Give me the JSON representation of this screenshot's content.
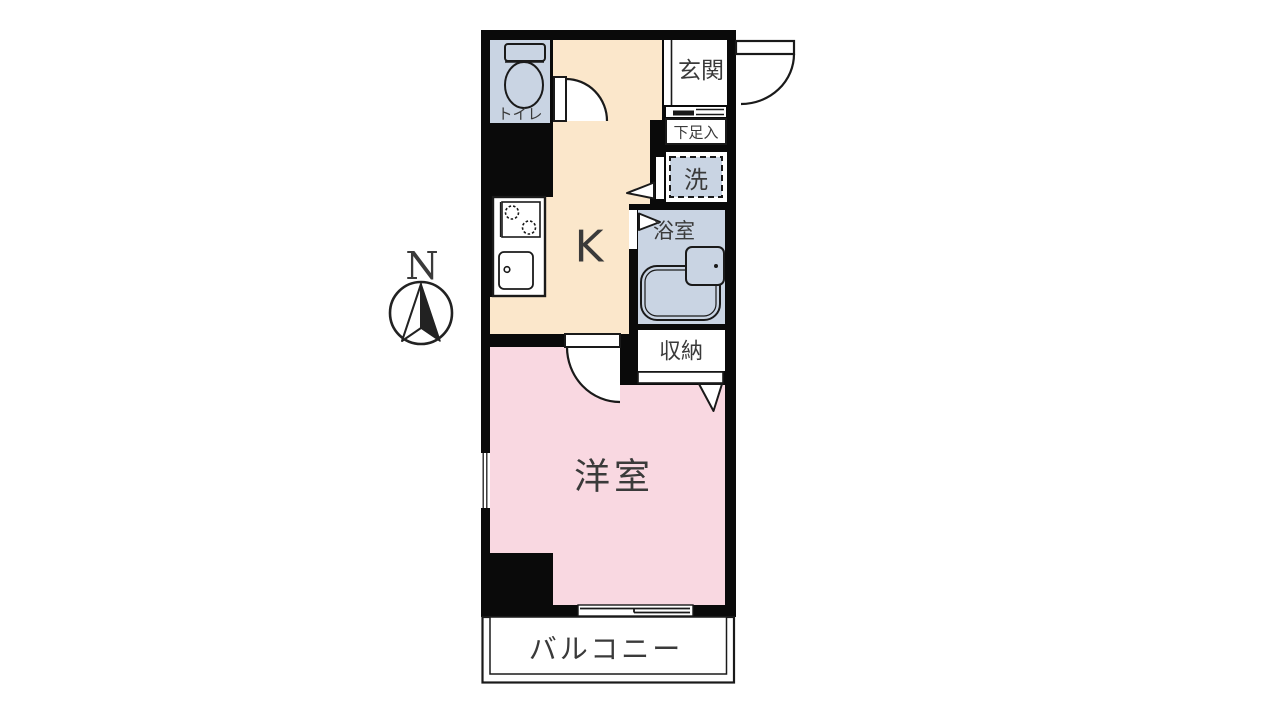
{
  "compass": {
    "north_label": "N"
  },
  "rooms": {
    "toilet": {
      "label": "トイレ"
    },
    "entrance": {
      "label": "玄関"
    },
    "shoe_cabinet": {
      "label": "下足入"
    },
    "laundry": {
      "label": "洗"
    },
    "kitchen": {
      "label": "K"
    },
    "bathroom": {
      "label": "浴室"
    },
    "storage": {
      "label": "収納"
    },
    "western_room": {
      "label": "洋室"
    },
    "balcony": {
      "label": "バルコニー"
    }
  },
  "colors": {
    "wall": "#0a0a0a",
    "kitchen_floor": "#fbe7cb",
    "western_room_floor": "#f9d8e1",
    "wet_area_floor": "#c9d4e3",
    "fixture_white": "#ffffff",
    "label_text": "#3a3a3a",
    "line": "#1a1a1a"
  }
}
